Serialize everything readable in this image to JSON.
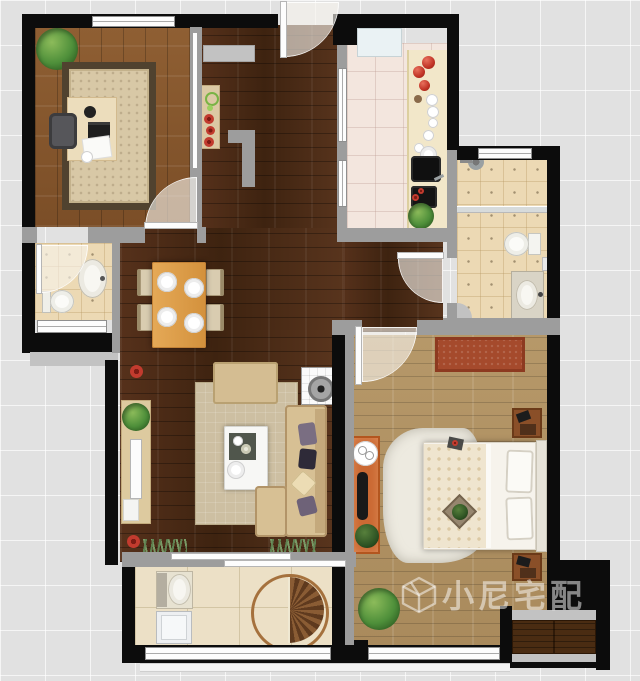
{
  "watermark": {
    "brand_text": "小尼宅配",
    "logo": "cube-logo"
  },
  "palette": {
    "background_tile": "#e1e1e1",
    "exterior_wall": "#0c0c0c",
    "interior_wall": "#9d9d9d",
    "wall_face": "#c2c2c2",
    "dark_wood_floor": "#492a15",
    "study_wood_floor": "#8a5a30",
    "bedroom_wood_floor": "#b2946a",
    "kitchen_tile": "#f3e6de",
    "bath_tile": "#ecd9b4",
    "balcony_tile": "#ece0c6",
    "window_white": "#fdfdfd",
    "door_swing": "#f7f4ed",
    "red_rug": "#a54a2c",
    "orange_runner": "#cb6a34",
    "plant_green": "#4e8f3a",
    "dining_table": "#dfa252",
    "sofa_beige": "#d7c094"
  },
  "rooms": [
    {
      "id": "study",
      "label": "Study",
      "furniture": [
        "desk",
        "office-chair",
        "area-rug",
        "plant",
        "laptop",
        "papers"
      ]
    },
    {
      "id": "entry-hall",
      "label": "Entry Hall",
      "furniture": [
        "entry-mat",
        "console-with-decor"
      ]
    },
    {
      "id": "kitchen",
      "label": "Kitchen",
      "furniture": [
        "fridge",
        "counter",
        "sink",
        "cooktop",
        "dishes",
        "tomatoes",
        "plant"
      ]
    },
    {
      "id": "bathroom-main",
      "label": "Main Bathroom",
      "furniture": [
        "shower-head",
        "glass-screen",
        "toilet",
        "vanity-sink"
      ]
    },
    {
      "id": "bathroom-guest",
      "label": "Guest Bathroom",
      "furniture": [
        "pedestal-sink",
        "toilet"
      ]
    },
    {
      "id": "dining",
      "label": "Dining Area",
      "furniture": [
        "dining-table",
        "chairs-4",
        "place-settings-4"
      ]
    },
    {
      "id": "living",
      "label": "Living Room",
      "furniture": [
        "sofa",
        "chaise",
        "pillows",
        "coffee-table",
        "tv-cabinet",
        "tv",
        "ottoman",
        "area-rug",
        "speaker",
        "plants",
        "flower-decals",
        "grass-decor"
      ]
    },
    {
      "id": "bedroom",
      "label": "Bedroom",
      "furniture": [
        "double-bed",
        "headboard",
        "pillows",
        "fur-rug",
        "red-rug",
        "runner-rug",
        "side-table",
        "bench",
        "nightstands-2",
        "plants",
        "wardrobe"
      ]
    },
    {
      "id": "balcony",
      "label": "Balcony",
      "furniture": [
        "laundry-sink",
        "washing-machine",
        "round-rug",
        "sliding-door"
      ]
    }
  ]
}
